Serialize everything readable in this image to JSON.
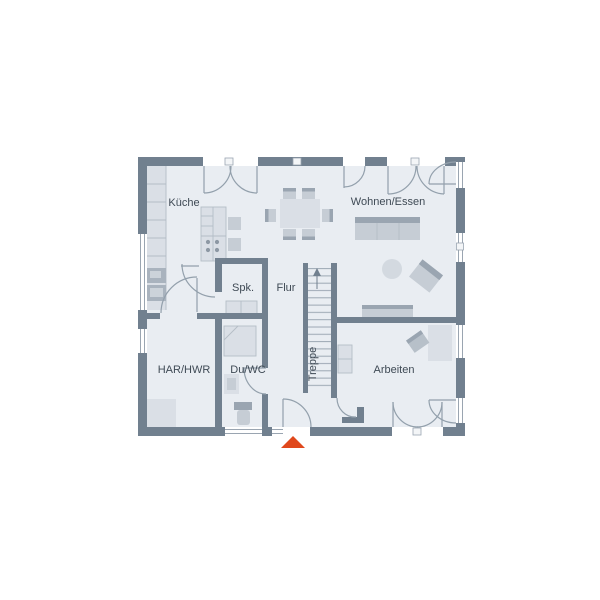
{
  "plan_title": "Erdgeschoss Grundriss",
  "rooms": {
    "kueche": "Küche",
    "wohnen_essen": "Wohnen/Essen",
    "spk": "Spk.",
    "flur": "Flur",
    "treppe": "Treppe",
    "har_hwr": "HAR/HWR",
    "du_wc": "Du/WC",
    "arbeiten": "Arbeiten"
  },
  "colors": {
    "wall": "#71808f",
    "floor": "#e9edf2",
    "line": "#93a0ac",
    "glaze": "#9aa5b1",
    "furn-light": "#dadfe6",
    "furn-mid": "#c6cdd5",
    "furn-dark": "#9aa5b1",
    "appl": "#a9b3be",
    "text": "#3f4a55",
    "accent": "#e0481c",
    "bg": "#ffffff"
  },
  "stairs": {
    "steps": 17,
    "direction_label": "Treppe"
  },
  "entrance": {
    "marker": "up-triangle"
  }
}
